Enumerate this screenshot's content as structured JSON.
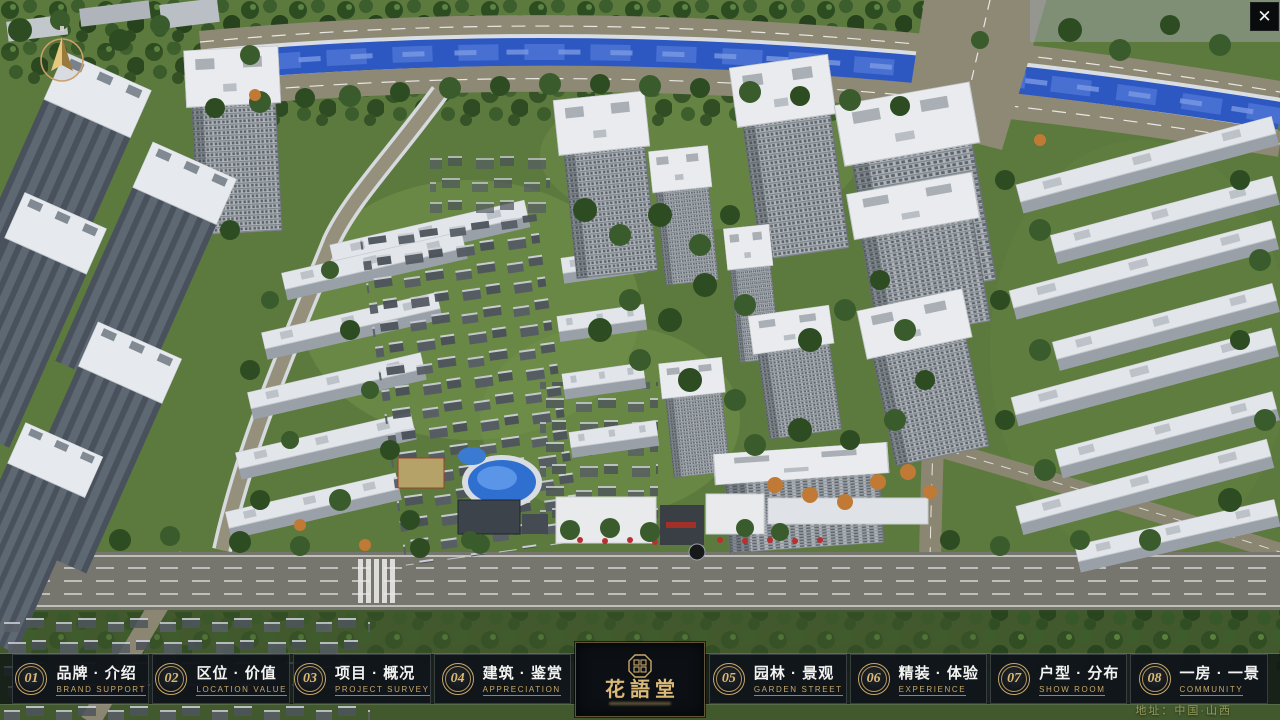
{
  "window": {
    "close_label": "✕"
  },
  "nav": {
    "items": [
      {
        "num": "01",
        "title": "品牌 · 介绍",
        "subtitle": "BRAND SUPPORT"
      },
      {
        "num": "02",
        "title": "区位 · 价值",
        "subtitle": "LOCATION VALUE"
      },
      {
        "num": "03",
        "title": "项目 · 概况",
        "subtitle": "PROJECT SURVEY"
      },
      {
        "num": "04",
        "title": "建筑 · 鉴赏",
        "subtitle": "APPRECIATION"
      },
      {
        "num": "05",
        "title": "园林 · 景观",
        "subtitle": "GARDEN STREET"
      },
      {
        "num": "06",
        "title": "精装 · 体验",
        "subtitle": "EXPERIENCE"
      },
      {
        "num": "07",
        "title": "户型 · 分布",
        "subtitle": "SHOW ROOM"
      },
      {
        "num": "08",
        "title": "一房 · 一景",
        "subtitle": "COMMUNITY"
      }
    ],
    "logo": {
      "title": "花語堂"
    }
  },
  "footer": {
    "address": "地址：中国·山西"
  },
  "colors": {
    "accent_gold": "#c9a96a",
    "bar_background": "#10151a",
    "river_blue": "#2d58c2",
    "lawn_green": "#5c7a3d"
  }
}
